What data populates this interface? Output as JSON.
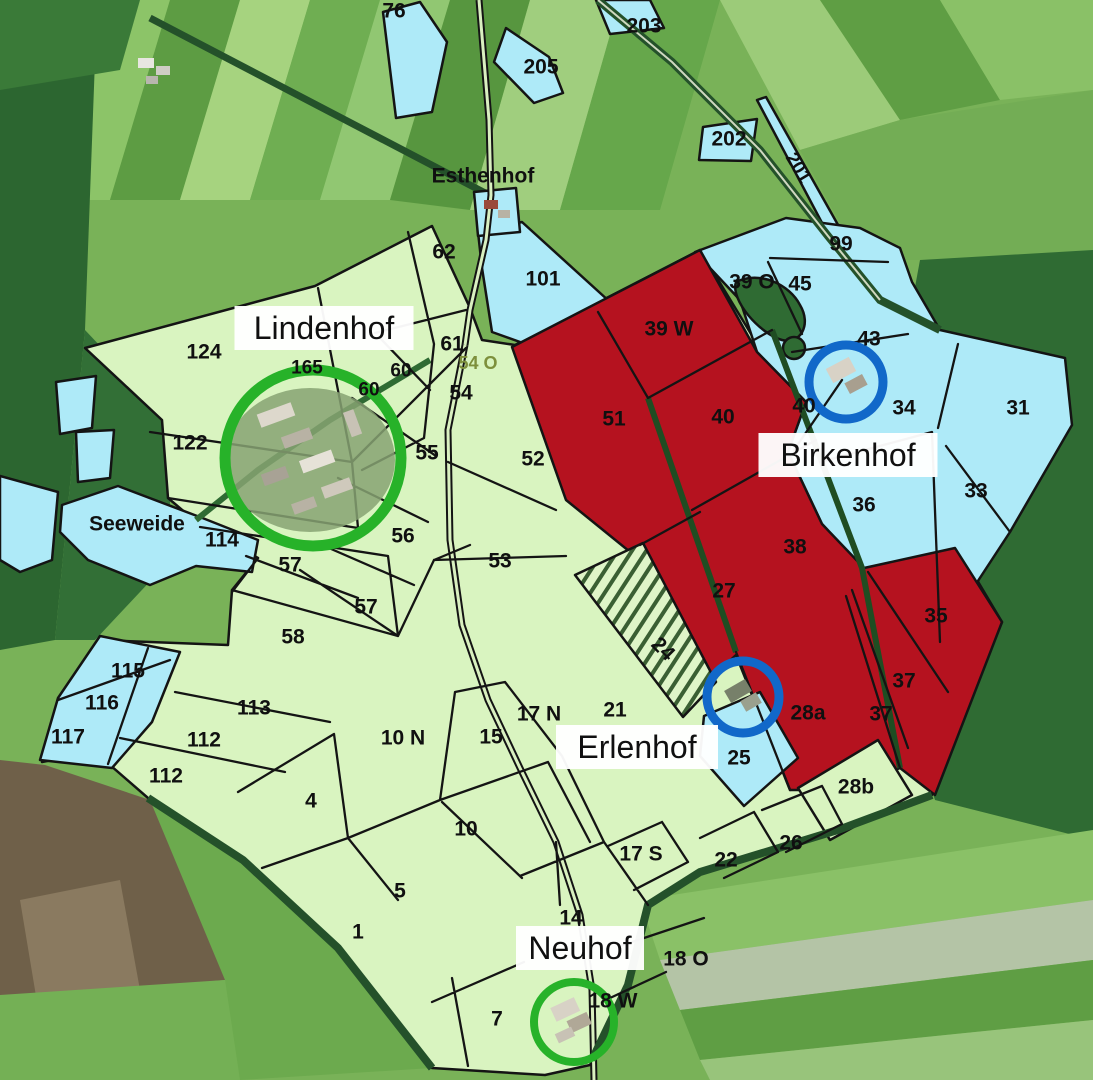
{
  "map": {
    "farms": [
      {
        "name": "Lindenhof",
        "x": 324,
        "y": 328,
        "boxed": true,
        "circle": "green",
        "cx": 313,
        "cy": 458,
        "r": 88
      },
      {
        "name": "Birkenhof",
        "x": 848,
        "y": 455,
        "boxed": true,
        "circle": "blue",
        "cx": 846,
        "cy": 382,
        "r": 37
      },
      {
        "name": "Erlenhof",
        "x": 637,
        "y": 747,
        "boxed": true,
        "circle": "blue",
        "cx": 743,
        "cy": 697,
        "r": 36
      },
      {
        "name": "Neuhof",
        "x": 580,
        "y": 948,
        "boxed": true,
        "circle": "green",
        "cx": 574,
        "cy": 1022,
        "r": 40
      }
    ],
    "places": [
      {
        "name": "Esthenhof",
        "x": 483,
        "y": 176
      },
      {
        "name": "Seeweide",
        "x": 137,
        "y": 524
      }
    ],
    "parcels": [
      {
        "label": "76",
        "x": 394,
        "y": 11
      },
      {
        "label": "203",
        "x": 644,
        "y": 26
      },
      {
        "label": "205",
        "x": 541,
        "y": 67
      },
      {
        "label": "202",
        "x": 729,
        "y": 139
      },
      {
        "label": "201",
        "x": 798,
        "y": 168,
        "rot": 59,
        "size": 19
      },
      {
        "label": "99",
        "x": 841,
        "y": 244
      },
      {
        "label": "39 O",
        "x": 752,
        "y": 282
      },
      {
        "label": "45",
        "x": 800,
        "y": 284
      },
      {
        "label": "101",
        "x": 543,
        "y": 279
      },
      {
        "label": "62",
        "x": 444,
        "y": 252
      },
      {
        "label": "43",
        "x": 869,
        "y": 339
      },
      {
        "label": "34",
        "x": 904,
        "y": 408
      },
      {
        "label": "31",
        "x": 1018,
        "y": 408
      },
      {
        "label": "33",
        "x": 976,
        "y": 491
      },
      {
        "label": "36",
        "x": 864,
        "y": 505
      },
      {
        "label": "40",
        "x": 804,
        "y": 406
      },
      {
        "label": "124",
        "x": 204,
        "y": 352
      },
      {
        "label": "165",
        "x": 307,
        "y": 368,
        "size": 19
      },
      {
        "label": "61",
        "x": 452,
        "y": 344
      },
      {
        "label": "60",
        "x": 401,
        "y": 371,
        "size": 19
      },
      {
        "label": "60",
        "x": 369,
        "y": 390,
        "size": 19
      },
      {
        "label": "54 O",
        "x": 478,
        "y": 363,
        "size": 18,
        "cls": "olive"
      },
      {
        "label": "54",
        "x": 461,
        "y": 393
      },
      {
        "label": "122",
        "x": 190,
        "y": 443
      },
      {
        "label": "55",
        "x": 427,
        "y": 453
      },
      {
        "label": "52",
        "x": 533,
        "y": 459
      },
      {
        "label": "114",
        "x": 222,
        "y": 540
      },
      {
        "label": "56",
        "x": 403,
        "y": 536
      },
      {
        "label": "57",
        "x": 290,
        "y": 565
      },
      {
        "label": "57",
        "x": 366,
        "y": 607
      },
      {
        "label": "53",
        "x": 500,
        "y": 561
      },
      {
        "label": "58",
        "x": 293,
        "y": 637
      },
      {
        "label": "115",
        "x": 128,
        "y": 671
      },
      {
        "label": "116",
        "x": 102,
        "y": 703
      },
      {
        "label": "117",
        "x": 68,
        "y": 737
      },
      {
        "label": "113",
        "x": 254,
        "y": 708
      },
      {
        "label": "112",
        "x": 204,
        "y": 740
      },
      {
        "label": "112",
        "x": 166,
        "y": 776
      },
      {
        "label": "39 W",
        "x": 669,
        "y": 329
      },
      {
        "label": "51",
        "x": 614,
        "y": 419
      },
      {
        "label": "40",
        "x": 723,
        "y": 417
      },
      {
        "label": "38",
        "x": 795,
        "y": 547
      },
      {
        "label": "27",
        "x": 724,
        "y": 591
      },
      {
        "label": "24",
        "x": 663,
        "y": 649,
        "rot": 45
      },
      {
        "label": "35",
        "x": 936,
        "y": 616
      },
      {
        "label": "37",
        "x": 904,
        "y": 681
      },
      {
        "label": "37",
        "x": 881,
        "y": 714
      },
      {
        "label": "28a",
        "x": 808,
        "y": 713
      },
      {
        "label": "25",
        "x": 739,
        "y": 758
      },
      {
        "label": "28b",
        "x": 856,
        "y": 787
      },
      {
        "label": "26",
        "x": 791,
        "y": 843
      },
      {
        "label": "22",
        "x": 726,
        "y": 860
      },
      {
        "label": "17 S",
        "x": 641,
        "y": 854
      },
      {
        "label": "21",
        "x": 615,
        "y": 710
      },
      {
        "label": "17 N",
        "x": 539,
        "y": 714
      },
      {
        "label": "15",
        "x": 491,
        "y": 737
      },
      {
        "label": "10 N",
        "x": 403,
        "y": 738
      },
      {
        "label": "4",
        "x": 311,
        "y": 801
      },
      {
        "label": "10",
        "x": 466,
        "y": 829
      },
      {
        "label": "5",
        "x": 400,
        "y": 891
      },
      {
        "label": "1",
        "x": 358,
        "y": 932
      },
      {
        "label": "14",
        "x": 571,
        "y": 918
      },
      {
        "label": "18 O",
        "x": 686,
        "y": 959
      },
      {
        "label": "18 W",
        "x": 613,
        "y": 1001
      },
      {
        "label": "7",
        "x": 497,
        "y": 1019
      }
    ],
    "colors": {
      "parcel_green": "#d9f4c0",
      "parcel_cyan": "#aeeaf8",
      "parcel_red": "#b5121f",
      "boundary_black": "#141414",
      "circle_green": "#27b229",
      "circle_blue": "#1168c9",
      "label_box_white": "#ffffff"
    }
  }
}
